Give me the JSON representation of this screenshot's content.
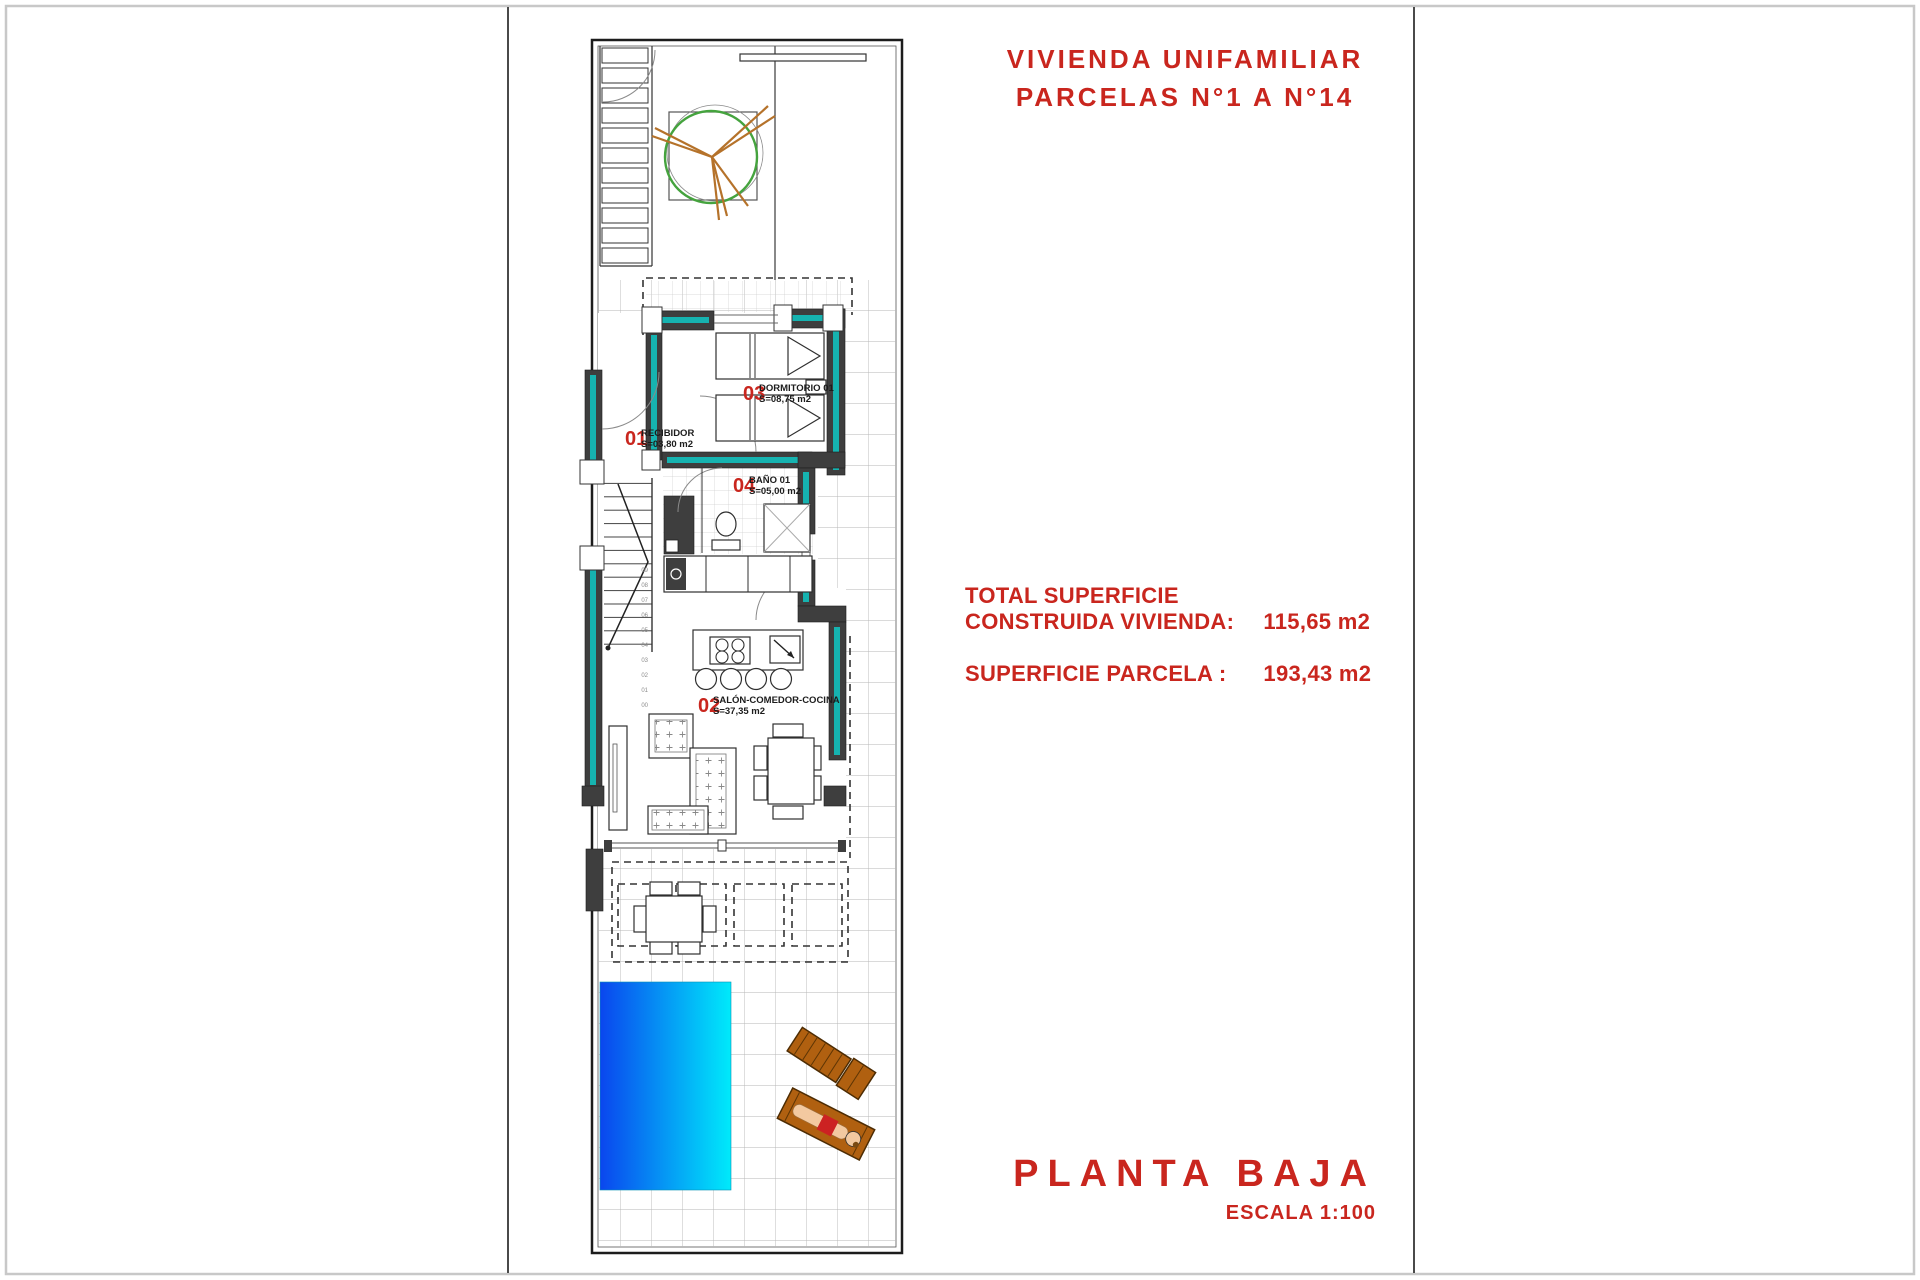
{
  "header": {
    "title_line1": "VIVIENDA UNIFAMILIAR",
    "title_line2": "PARCELAS N°1 A N°14"
  },
  "summary": {
    "line1": "TOTAL SUPERFICIE",
    "line2_label": "CONSTRUIDA VIVIENDA:",
    "line2_value": "115,65 m2",
    "line3_label": "SUPERFICIE PARCELA :",
    "line3_value": "193,43 m2"
  },
  "footer": {
    "plan_name": "PLANTA BAJA",
    "scale": "ESCALA 1:100"
  },
  "rooms": [
    {
      "number": "01",
      "name": "RECIBIDOR",
      "area": "S=03,80 m2"
    },
    {
      "number": "02",
      "name": "SALÓN-COMEDOR-COCINA",
      "area": "S=37,35 m2"
    },
    {
      "number": "03",
      "name": "DORMITORIO 01",
      "area": "S=08,75 m2"
    },
    {
      "number": "04",
      "name": "BAÑO 01",
      "area": "S=05,00 m2"
    }
  ],
  "stairs": {
    "step_labels": [
      "09",
      "08",
      "07",
      "06",
      "05",
      "04",
      "03",
      "02",
      "01",
      "00"
    ]
  },
  "colors": {
    "accent_red": "#c9261e",
    "wall_gray": "#3e3e3e",
    "insulation_teal": "#16b3b0",
    "pool_left": "#0a46ee",
    "pool_right": "#00eafb",
    "tree_green": "#45a33e",
    "branch_brown": "#b5722a",
    "lounger_brown": "#b06010",
    "grid_gray": "#b6b6b6"
  }
}
